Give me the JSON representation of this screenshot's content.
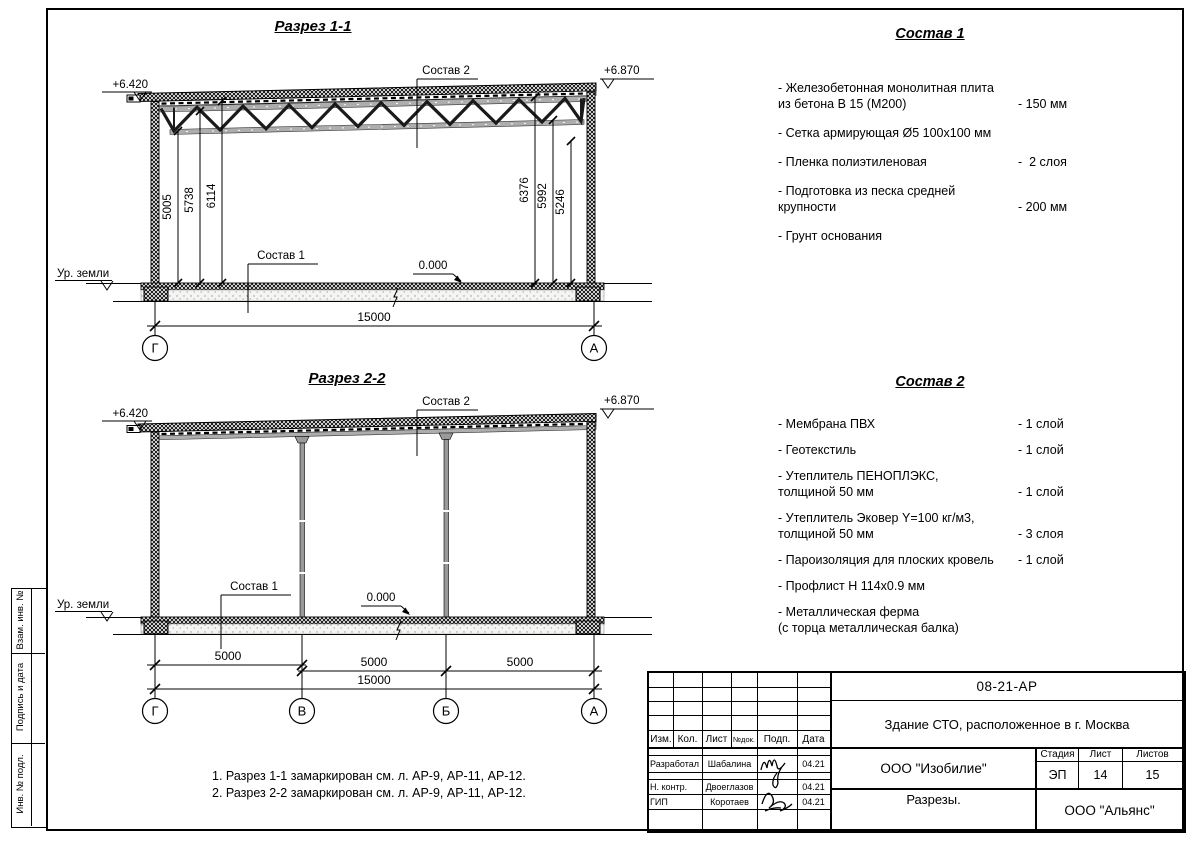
{
  "section1": {
    "title": "Разрез 1-1",
    "elev_left": "+6.420",
    "elev_right": "+6.870",
    "ground": "Ур. земли",
    "zero": "0.000",
    "label_sostav1": "Состав 1",
    "label_sostav2": "Состав 2",
    "dims_left": [
      "5005",
      "5738",
      "6114"
    ],
    "dims_right": [
      "6376",
      "5992",
      "5246"
    ],
    "dim_total": "15000",
    "axis_left": "Г",
    "axis_right": "А"
  },
  "section2": {
    "title": "Разрез 2-2",
    "elev_left": "+6.420",
    "elev_right": "+6.870",
    "ground": "Ур. земли",
    "zero": "0.000",
    "label_sostav1": "Состав 1",
    "label_sostav2": "Состав 2",
    "dims_bays": [
      "5000",
      "5000",
      "5000"
    ],
    "dim_total": "15000",
    "axes": [
      "Г",
      "В",
      "Б",
      "А"
    ]
  },
  "sostav1": {
    "title": "Состав 1",
    "items": [
      {
        "name": "- Железобетонная  монолитная плита\nиз бетона В 15 (М200)",
        "value": "- 150 мм"
      },
      {
        "name": "- Сетка армирующая Ø5 100х100 мм",
        "value": ""
      },
      {
        "name": "- Пленка полиэтиленовая",
        "value": "-  2 слоя"
      },
      {
        "name": "- Подготовка из песка средней\nкрупности",
        "value": "- 200 мм"
      },
      {
        "name": "- Грунт основания",
        "value": ""
      }
    ]
  },
  "sostav2": {
    "title": "Состав 2",
    "items": [
      {
        "name": "- Мембрана ПВХ",
        "value": "- 1 слой"
      },
      {
        "name": "- Геотекстиль",
        "value": "- 1 слой"
      },
      {
        "name": "- Утеплитель ПЕНОПЛЭКС,\nтолщиной 50 мм",
        "value": "- 1 слой"
      },
      {
        "name": "- Утеплитель Эковер Y=100 кг/м3,\nтолщиной 50 мм",
        "value": "- 3 слоя"
      },
      {
        "name": "- Пароизоляция для плоских кровель",
        "value": "- 1 слой"
      },
      {
        "name": "- Профлист Н 114х0.9 мм",
        "value": ""
      },
      {
        "name": "- Металлическая ферма\n(с торца металлическая балка)",
        "value": ""
      }
    ]
  },
  "notes": {
    "line1": "1. Разрез 1-1 замаркирован см. л. АР-9, АР-11, АР-12.",
    "line2": "2. Разрез 2-2 замаркирован см. л. АР-9, АР-11, АР-12."
  },
  "stamp": {
    "doc_number": "08-21-АР",
    "project_title": "Здание СТО, расположенное в г. Москва",
    "designer_org": "ООО \"Изобилие\"",
    "sheet_name": "Разрезы.",
    "contractor_org": "ООО \"Альянс\"",
    "stage_label": "Стадия",
    "stage_value": "ЭП",
    "sheet_label": "Лист",
    "sheet_value": "14",
    "sheets_label": "Листов",
    "sheets_value": "15",
    "cols": {
      "c1": "Изм.",
      "c2": "Кол.",
      "c3": "Лист",
      "c4": "№док.",
      "c5": "Подп.",
      "c6": "Дата"
    },
    "rows": [
      {
        "role": "Разработал",
        "name": "Шабалина",
        "date": "04.21"
      },
      {
        "role": "Н. контр.",
        "name": "Двоеглазов",
        "date": "04.21"
      },
      {
        "role": "ГИП",
        "name": "Коротаев",
        "date": "04.21"
      }
    ]
  },
  "side_strip": {
    "cell1": "Взам. инв. №",
    "cell2": "Подпись и дата",
    "cell3": "Инв. № подл."
  }
}
